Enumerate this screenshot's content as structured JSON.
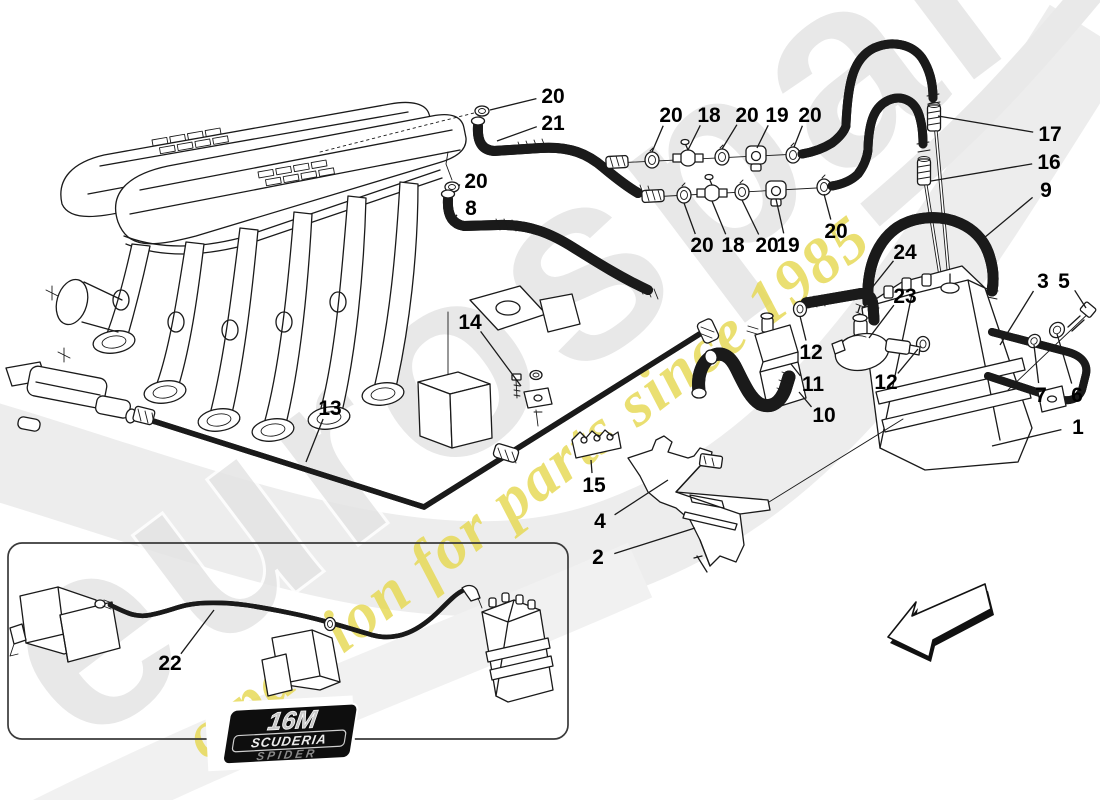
{
  "page": {
    "width": 1100,
    "height": 800,
    "background": "#ffffff"
  },
  "watermark": {
    "brand_text": "eurospares",
    "tagline_text": "a passion for parts since 1985",
    "brand_fill": "#e4e4e4",
    "brand_outline": "#ffffff",
    "tagline_color": "#e6d84e",
    "ribbon_color": "#ededed",
    "angle_deg": -37
  },
  "inset": {
    "badge_line1": "16M",
    "badge_line2": "SCUDERIA",
    "badge_line3": "SPIDER"
  },
  "direction_arrow": {
    "meaning": "viewing-direction",
    "points": "lower-left"
  },
  "callouts": [
    {
      "num": "20",
      "x": 553,
      "y": 96,
      "tx": 490,
      "ty": 110
    },
    {
      "num": "21",
      "x": 553,
      "y": 123,
      "tx": 497,
      "ty": 141
    },
    {
      "num": "20",
      "x": 476,
      "y": 181,
      "tx": 459,
      "ty": 186
    },
    {
      "num": "8",
      "x": 471,
      "y": 208,
      "tx": 452,
      "ty": 221
    },
    {
      "num": "20",
      "x": 671,
      "y": 115,
      "tx": 652,
      "ty": 152
    },
    {
      "num": "18",
      "x": 709,
      "y": 115,
      "tx": 688,
      "ty": 150
    },
    {
      "num": "20",
      "x": 747,
      "y": 115,
      "tx": 722,
      "ty": 149
    },
    {
      "num": "19",
      "x": 777,
      "y": 115,
      "tx": 757,
      "ty": 148
    },
    {
      "num": "20",
      "x": 810,
      "y": 115,
      "tx": 794,
      "ty": 147
    },
    {
      "num": "17",
      "x": 1050,
      "y": 134,
      "tx": 938,
      "ty": 116
    },
    {
      "num": "16",
      "x": 1049,
      "y": 162,
      "tx": 931,
      "ty": 181
    },
    {
      "num": "9",
      "x": 1046,
      "y": 190,
      "tx": 978,
      "ty": 243
    },
    {
      "num": "20",
      "x": 702,
      "y": 245,
      "tx": 684,
      "ty": 203
    },
    {
      "num": "18",
      "x": 733,
      "y": 245,
      "tx": 712,
      "ty": 201
    },
    {
      "num": "20",
      "x": 767,
      "y": 245,
      "tx": 742,
      "ty": 200
    },
    {
      "num": "19",
      "x": 788,
      "y": 245,
      "tx": 776,
      "ty": 199
    },
    {
      "num": "20",
      "x": 836,
      "y": 231,
      "tx": 824,
      "ty": 194
    },
    {
      "num": "24",
      "x": 905,
      "y": 252,
      "tx": 871,
      "ty": 289
    },
    {
      "num": "23",
      "x": 905,
      "y": 296,
      "tx": 869,
      "ty": 338
    },
    {
      "num": "3",
      "x": 1043,
      "y": 281,
      "tx": 1000,
      "ty": 345
    },
    {
      "num": "5",
      "x": 1064,
      "y": 281,
      "tx": 1086,
      "ty": 308
    },
    {
      "num": "12",
      "x": 811,
      "y": 352,
      "tx": 800,
      "ty": 316
    },
    {
      "num": "11",
      "x": 813,
      "y": 384,
      "tx": 791,
      "ty": 364
    },
    {
      "num": "12",
      "x": 886,
      "y": 382,
      "tx": 918,
      "ty": 349
    },
    {
      "num": "10",
      "x": 824,
      "y": 415,
      "tx": 799,
      "ty": 392
    },
    {
      "num": "7",
      "x": 1041,
      "y": 395,
      "tx": 1034,
      "ty": 345
    },
    {
      "num": "6",
      "x": 1077,
      "y": 395,
      "tx": 1057,
      "ty": 334
    },
    {
      "num": "1",
      "x": 1078,
      "y": 427,
      "tx": 992,
      "ty": 446
    },
    {
      "num": "14",
      "x": 470,
      "y": 322,
      "tx": 521,
      "ty": 386
    },
    {
      "num": "13",
      "x": 330,
      "y": 408,
      "tx": 306,
      "ty": 462
    },
    {
      "num": "15",
      "x": 594,
      "y": 485,
      "tx": 591,
      "ty": 460
    },
    {
      "num": "4",
      "x": 600,
      "y": 521,
      "tx": 668,
      "ty": 480
    },
    {
      "num": "2",
      "x": 598,
      "y": 557,
      "tx": 695,
      "ty": 528
    },
    {
      "num": "22",
      "x": 170,
      "y": 663,
      "tx": 214,
      "ty": 610
    }
  ]
}
